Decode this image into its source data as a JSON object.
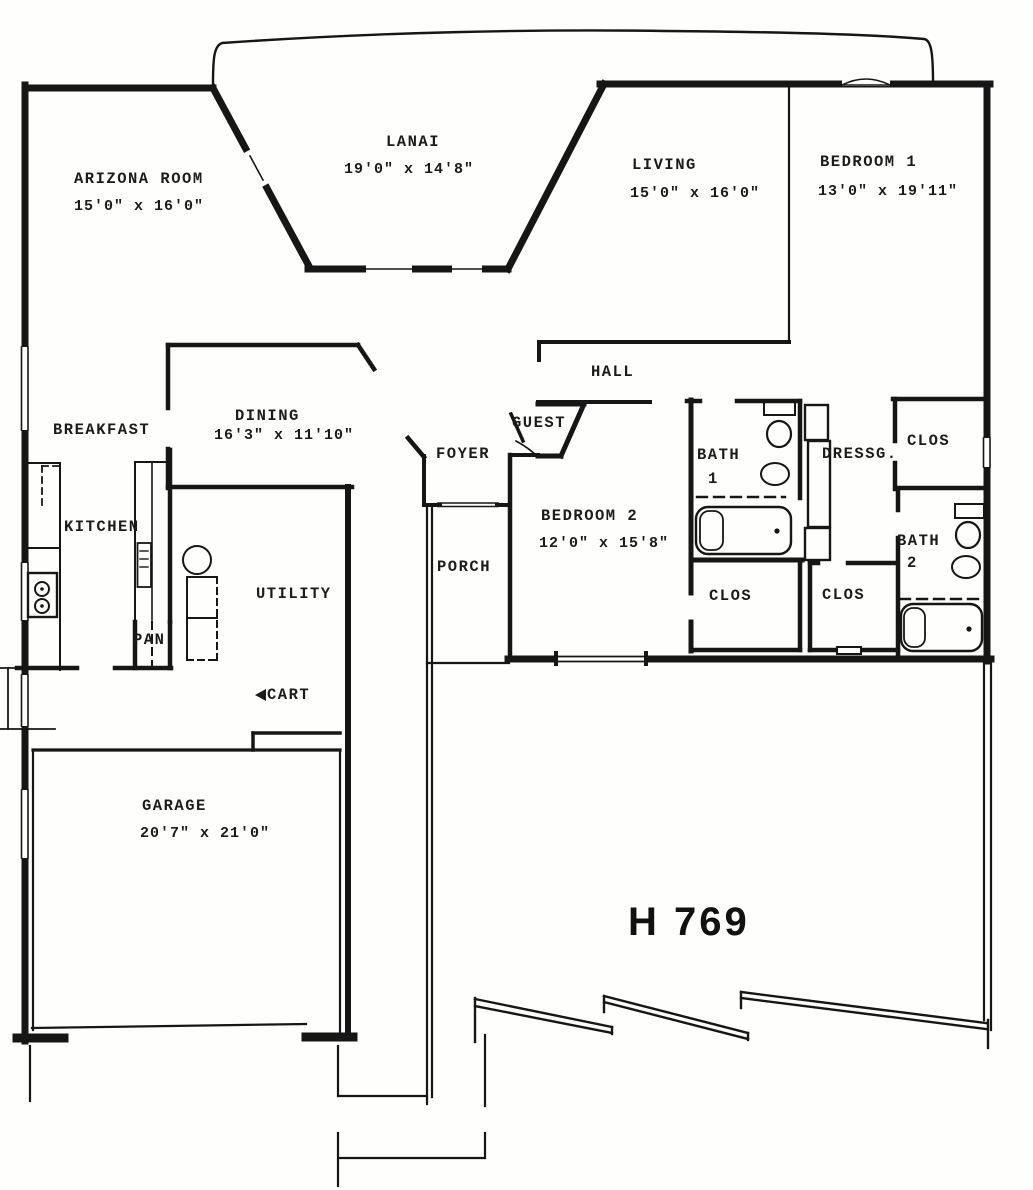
{
  "plan_id": "H 769",
  "colors": {
    "ink": "#161616",
    "paper": "#fefefc"
  },
  "rooms": {
    "arizona_room": {
      "name": "ARIZONA ROOM",
      "dims": "15'0\" x 16'0\""
    },
    "lanai": {
      "name": "LANAI",
      "dims": "19'0\" x 14'8\""
    },
    "living": {
      "name": "LIVING",
      "dims": "15'0\" x 16'0\""
    },
    "bedroom1": {
      "name": "BEDROOM 1",
      "dims": "13'0\" x 19'11\""
    },
    "hall": {
      "name": "HALL"
    },
    "breakfast": {
      "name": "BREAKFAST"
    },
    "dining": {
      "name": "DINING",
      "dims": "16'3\" x 11'10\""
    },
    "guest": {
      "name": "GUEST"
    },
    "foyer": {
      "name": "FOYER"
    },
    "kitchen": {
      "name": "KITCHEN"
    },
    "bath1": {
      "name": "BATH",
      "number": "1"
    },
    "dressing": {
      "name": "DRESSG."
    },
    "closet_bedroom1": {
      "name": "CLOS"
    },
    "bedroom2": {
      "name": "BEDROOM 2",
      "dims": "12'0\" x 15'8\""
    },
    "porch": {
      "name": "PORCH"
    },
    "bath2": {
      "name": "BATH",
      "number": "2"
    },
    "utility": {
      "name": "UTILITY"
    },
    "pantry": {
      "name": "PAN"
    },
    "closet_hall_left": {
      "name": "CLOS"
    },
    "closet_hall_right": {
      "name": "CLOS"
    },
    "cart": {
      "name": "CART"
    },
    "garage": {
      "name": "GARAGE",
      "dims": "20'7\" x 21'0\""
    }
  }
}
